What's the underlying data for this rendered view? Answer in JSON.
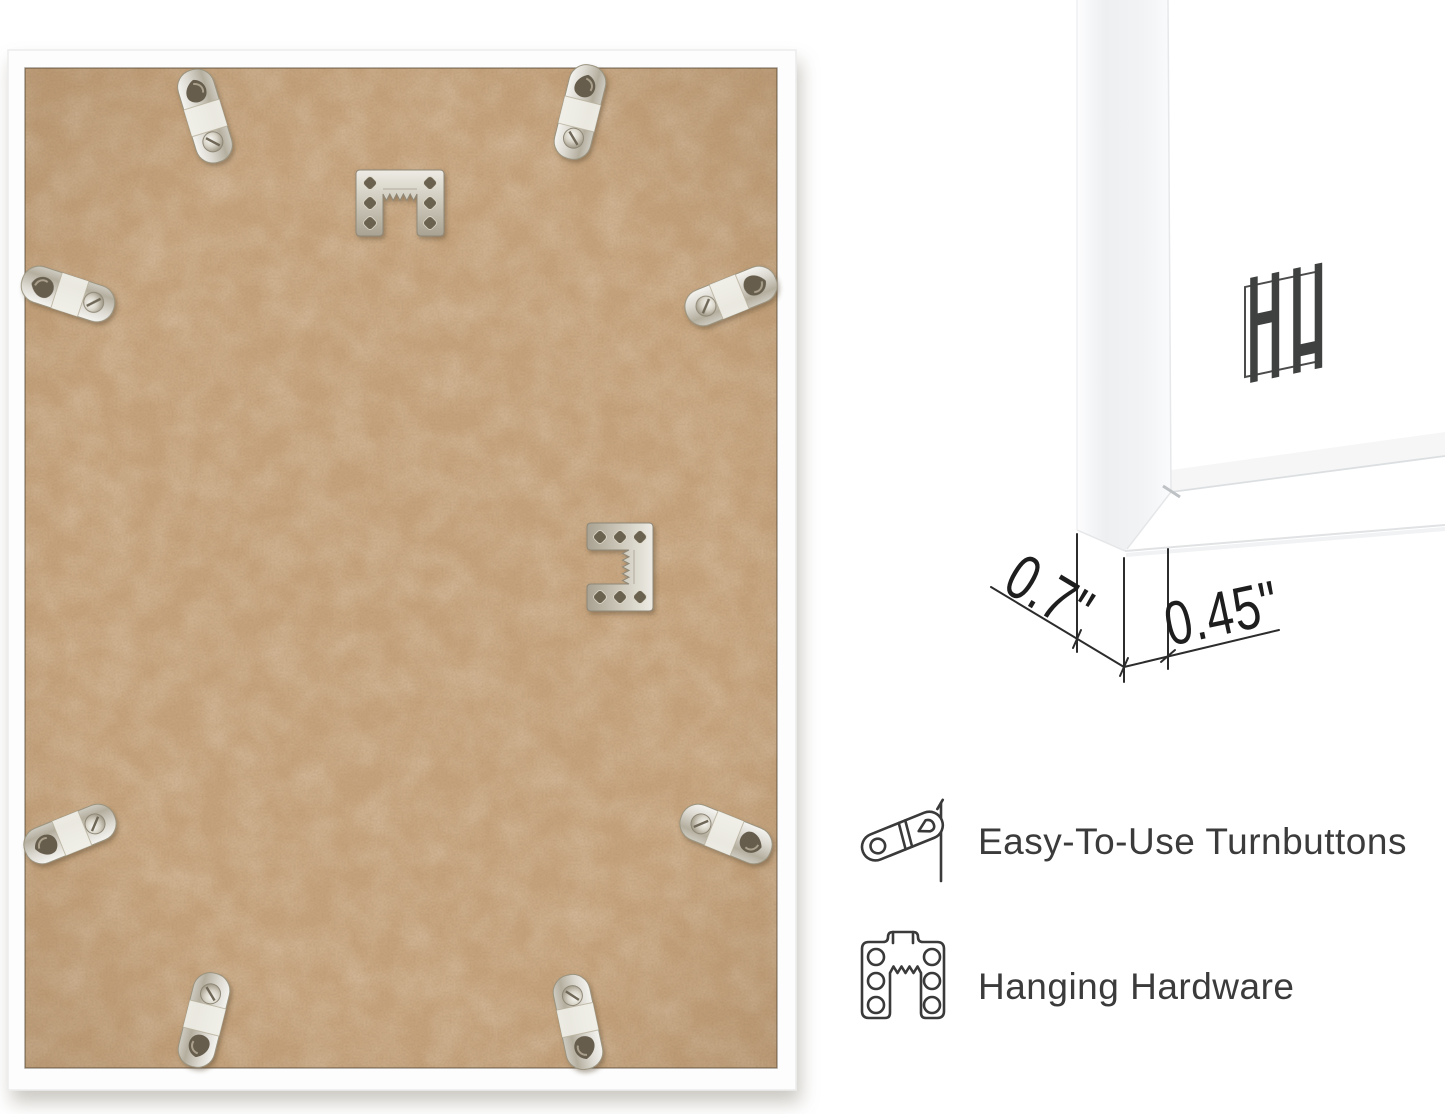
{
  "graphic": {
    "description": "picture-frame product infographic",
    "background_color": "#ffffff",
    "accent_text_color": "#3b3b3b",
    "dimension_line_color": "#2c2c2c"
  },
  "frame_back_photo": {
    "label": "back of white picture frame with MDF backing board",
    "frame_color": "#fdfdfd",
    "board_color": "#c6a37c",
    "metal_color": "#d9d7d0",
    "turnbuttons": [
      {
        "x": 205,
        "y": 116,
        "angle": -17
      },
      {
        "x": 580,
        "y": 112,
        "angle": 14
      },
      {
        "x": 68,
        "y": 294,
        "angle": -72
      },
      {
        "x": 731,
        "y": 296,
        "angle": 68
      },
      {
        "x": 70,
        "y": 834,
        "angle": -112
      },
      {
        "x": 726,
        "y": 834,
        "angle": 112
      },
      {
        "x": 204,
        "y": 1020,
        "angle": 194
      },
      {
        "x": 578,
        "y": 1022,
        "angle": 168
      }
    ],
    "sawtooth_hangers": [
      {
        "x": 400,
        "y": 203,
        "angle": 0
      },
      {
        "x": 620,
        "y": 567,
        "angle": 90
      }
    ]
  },
  "corner_detail": {
    "label": "white frame corner close-up",
    "logo_icon": "hh-bars-logo",
    "depth_label": "0.7\"",
    "face_width_label": "0.45\""
  },
  "features": [
    {
      "icon": "turnbutton-icon",
      "label": "Easy-To-Use Turnbuttons"
    },
    {
      "icon": "hanging-hardware-icon",
      "label": "Hanging Hardware"
    }
  ]
}
